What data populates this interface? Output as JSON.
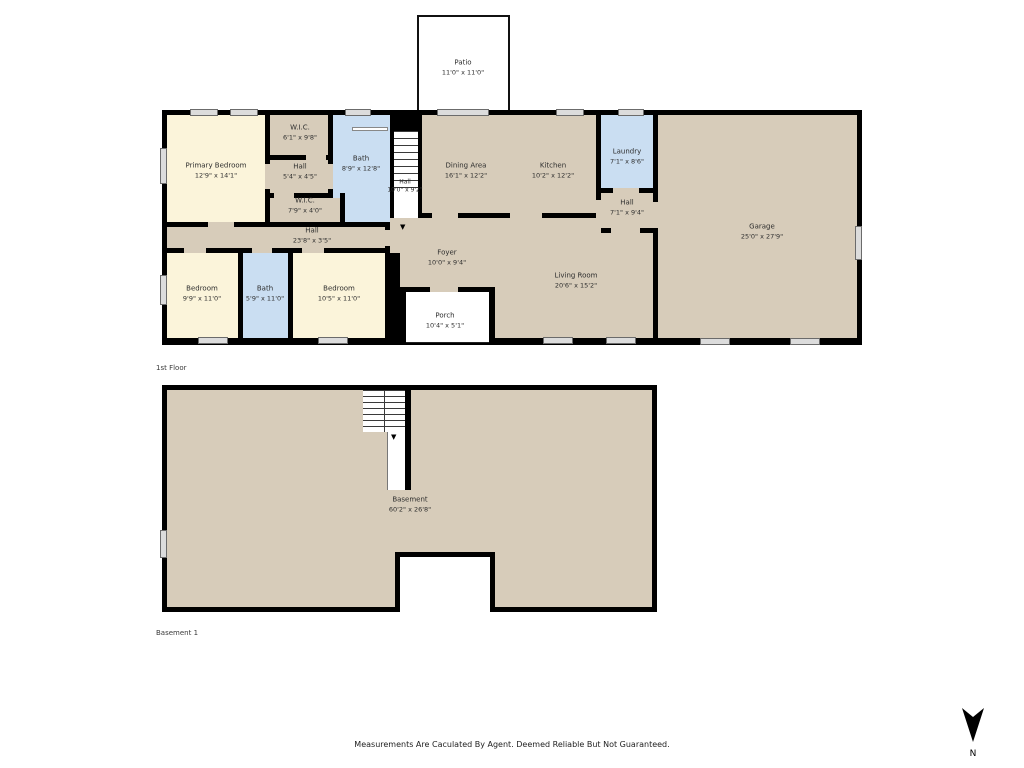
{
  "rooms": [
    {
      "name": "Patio",
      "dims": "11'0\" x 11'0\""
    },
    {
      "name": "Primary Bedroom",
      "dims": "12'9\" x 14'1\""
    },
    {
      "name": "W.I.C.",
      "dims": "6'1\" x 9'8\""
    },
    {
      "name": "Hall",
      "dims": "5'4\" x 4'5\""
    },
    {
      "name": "Bath",
      "dims": "8'9\" x 12'8\""
    },
    {
      "name": "W.I.C.",
      "dims": "7'9\" x 4'0\""
    },
    {
      "name": "Hall",
      "dims": "10'0\" x 9'2\""
    },
    {
      "name": "Dining Area",
      "dims": "16'1\" x 12'2\""
    },
    {
      "name": "Kitchen",
      "dims": "10'2\" x 12'2\""
    },
    {
      "name": "Laundry",
      "dims": "7'1\" x 8'6\""
    },
    {
      "name": "Hall",
      "dims": "7'1\" x 9'4\""
    },
    {
      "name": "Garage",
      "dims": "25'0\" x 27'9\""
    },
    {
      "name": "Hall",
      "dims": "23'8\" x 3'5\""
    },
    {
      "name": "Bedroom",
      "dims": "9'9\" x 11'0\""
    },
    {
      "name": "Bath",
      "dims": "5'9\" x 11'0\""
    },
    {
      "name": "Bedroom",
      "dims": "10'5\" x 11'0\""
    },
    {
      "name": "Foyer",
      "dims": "10'0\" x 9'4\""
    },
    {
      "name": "Living Room",
      "dims": "20'6\" x 15'2\""
    },
    {
      "name": "Porch",
      "dims": "10'4\" x 5'1\""
    },
    {
      "name": "Basement",
      "dims": "60'2\" x 26'8\""
    }
  ],
  "captions": {
    "floor1": "1st Floor",
    "basement": "Basement 1"
  },
  "footer": {
    "disclaimer": "Measurements Are Caculated By Agent. Deemed Reliable But Not Guaranteed."
  },
  "compass": {
    "label": "N"
  },
  "colors": {
    "wall": "#000000",
    "room_tan": "#d7ccba",
    "room_cream": "#fbf4da",
    "room_blue": "#cadef2",
    "window": "#dcdcdc"
  }
}
